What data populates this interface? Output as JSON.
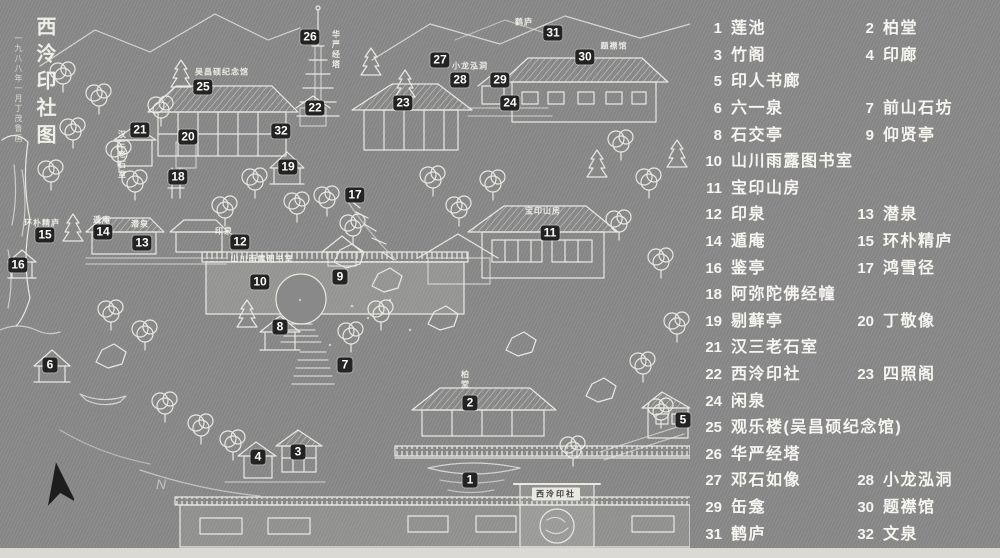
{
  "title": {
    "main": "西泠印社图",
    "sub": "一九八八年一月丁茂鲁画"
  },
  "compass": {
    "label": "N"
  },
  "colors": {
    "background": "#8a8a8a",
    "ink": "#efeee8",
    "marker_bg": "#232323",
    "marker_text": "#ffffff",
    "plaque_bg": "#e9e8e1"
  },
  "legend": {
    "rows": [
      {
        "entries": [
          {
            "num": "1",
            "label": "莲池"
          },
          {
            "num": "2",
            "label": "柏堂"
          }
        ]
      },
      {
        "entries": [
          {
            "num": "3",
            "label": "竹阁"
          },
          {
            "num": "4",
            "label": "印廊"
          }
        ]
      },
      {
        "entries": [
          {
            "num": "5",
            "label": "印人书廊"
          }
        ]
      },
      {
        "entries": [
          {
            "num": "6",
            "label": "六一泉"
          },
          {
            "num": "7",
            "label": "前山石坊"
          }
        ]
      },
      {
        "entries": [
          {
            "num": "8",
            "label": "石交亭"
          },
          {
            "num": "9",
            "label": "仰贤亭"
          }
        ]
      },
      {
        "entries": [
          {
            "num": "10",
            "label": "山川雨露图书室"
          }
        ]
      },
      {
        "entries": [
          {
            "num": "11",
            "label": "宝印山房"
          }
        ]
      },
      {
        "entries": [
          {
            "num": "12",
            "label": "印泉"
          },
          {
            "num": "13",
            "label": "潜泉"
          }
        ]
      },
      {
        "entries": [
          {
            "num": "14",
            "label": "遁庵"
          },
          {
            "num": "15",
            "label": "环朴精庐"
          }
        ]
      },
      {
        "entries": [
          {
            "num": "16",
            "label": "鉴亭"
          },
          {
            "num": "17",
            "label": "鸿雪径"
          }
        ]
      },
      {
        "entries": [
          {
            "num": "18",
            "label": "阿弥陀佛经幢"
          }
        ]
      },
      {
        "entries": [
          {
            "num": "19",
            "label": "剔藓亭"
          },
          {
            "num": "20",
            "label": "丁敬像"
          }
        ]
      },
      {
        "entries": [
          {
            "num": "21",
            "label": "汉三老石室"
          }
        ]
      },
      {
        "entries": [
          {
            "num": "22",
            "label": "西泠印社"
          },
          {
            "num": "23",
            "label": "四照阁"
          }
        ]
      },
      {
        "entries": [
          {
            "num": "24",
            "label": "闲泉"
          }
        ]
      },
      {
        "entries": [
          {
            "num": "25",
            "label": "观乐楼(吴昌硕纪念馆)"
          }
        ]
      },
      {
        "entries": [
          {
            "num": "26",
            "label": "华严经塔"
          }
        ]
      },
      {
        "entries": [
          {
            "num": "27",
            "label": "邓石如像"
          },
          {
            "num": "28",
            "label": "小龙泓洞"
          }
        ]
      },
      {
        "entries": [
          {
            "num": "29",
            "label": "缶龛"
          },
          {
            "num": "30",
            "label": "题襟馆"
          }
        ]
      },
      {
        "entries": [
          {
            "num": "31",
            "label": "鹤庐"
          },
          {
            "num": "32",
            "label": "文泉"
          }
        ]
      }
    ]
  },
  "map": {
    "markers": [
      {
        "num": "1",
        "name": "莲池",
        "x": 470,
        "y": 480
      },
      {
        "num": "2",
        "name": "柏堂",
        "x": 470,
        "y": 403
      },
      {
        "num": "3",
        "name": "竹阁",
        "x": 298,
        "y": 452
      },
      {
        "num": "4",
        "name": "印廊",
        "x": 258,
        "y": 457
      },
      {
        "num": "5",
        "name": "印人书廊",
        "x": 683,
        "y": 420
      },
      {
        "num": "6",
        "name": "六一泉",
        "x": 50,
        "y": 365
      },
      {
        "num": "7",
        "name": "前山石坊",
        "x": 345,
        "y": 365
      },
      {
        "num": "8",
        "name": "石交亭",
        "x": 280,
        "y": 327
      },
      {
        "num": "9",
        "name": "仰贤亭",
        "x": 340,
        "y": 277
      },
      {
        "num": "10",
        "name": "山川雨露图书室",
        "x": 260,
        "y": 282
      },
      {
        "num": "11",
        "name": "宝印山房",
        "x": 550,
        "y": 233
      },
      {
        "num": "12",
        "name": "印泉",
        "x": 240,
        "y": 242
      },
      {
        "num": "13",
        "name": "潜泉",
        "x": 142,
        "y": 243
      },
      {
        "num": "14",
        "name": "遁庵",
        "x": 103,
        "y": 232
      },
      {
        "num": "15",
        "name": "环朴精庐",
        "x": 45,
        "y": 235
      },
      {
        "num": "16",
        "name": "鉴亭",
        "x": 18,
        "y": 265
      },
      {
        "num": "17",
        "name": "鸿雪径",
        "x": 355,
        "y": 195
      },
      {
        "num": "18",
        "name": "阿弥陀佛经幢",
        "x": 178,
        "y": 177
      },
      {
        "num": "19",
        "name": "剔藓亭",
        "x": 288,
        "y": 167
      },
      {
        "num": "20",
        "name": "丁敬像",
        "x": 188,
        "y": 137
      },
      {
        "num": "21",
        "name": "汉三老石室",
        "x": 140,
        "y": 130
      },
      {
        "num": "22",
        "name": "西泠印社",
        "x": 315,
        "y": 108
      },
      {
        "num": "23",
        "name": "四照阁",
        "x": 403,
        "y": 103
      },
      {
        "num": "24",
        "name": "闲泉",
        "x": 510,
        "y": 103
      },
      {
        "num": "25",
        "name": "观乐楼",
        "x": 203,
        "y": 87
      },
      {
        "num": "26",
        "name": "华严经塔",
        "x": 310,
        "y": 37
      },
      {
        "num": "27",
        "name": "邓石如像",
        "x": 440,
        "y": 60
      },
      {
        "num": "28",
        "name": "小龙泓洞",
        "x": 460,
        "y": 80
      },
      {
        "num": "29",
        "name": "缶龛",
        "x": 500,
        "y": 80
      },
      {
        "num": "30",
        "name": "题襟馆",
        "x": 585,
        "y": 57
      },
      {
        "num": "31",
        "name": "鹤庐",
        "x": 553,
        "y": 33
      },
      {
        "num": "32",
        "name": "文泉",
        "x": 281,
        "y": 131
      }
    ],
    "labels": [
      {
        "text": "华严经塔",
        "x": 336,
        "y": 50,
        "vertical": true
      },
      {
        "text": "吴昌硕纪念馆",
        "x": 222,
        "y": 72
      },
      {
        "text": "汉三老石室",
        "x": 122,
        "y": 155,
        "vertical": true
      },
      {
        "text": "山川雨露图书室",
        "x": 262,
        "y": 259
      },
      {
        "text": "宝印山房",
        "x": 543,
        "y": 211
      },
      {
        "text": "印泉",
        "x": 224,
        "y": 231
      },
      {
        "text": "潜泉",
        "x": 140,
        "y": 224
      },
      {
        "text": "遁庵",
        "x": 102,
        "y": 220
      },
      {
        "text": "环朴精庐",
        "x": 42,
        "y": 223
      },
      {
        "text": "柏堂",
        "x": 465,
        "y": 380,
        "vertical": true
      },
      {
        "text": "小龙泓洞",
        "x": 470,
        "y": 66
      },
      {
        "text": "题襟馆",
        "x": 614,
        "y": 46
      },
      {
        "text": "鹤庐",
        "x": 524,
        "y": 22
      },
      {
        "text": "西泠印社",
        "x": 556,
        "y": 494,
        "plaque": true
      }
    ]
  }
}
